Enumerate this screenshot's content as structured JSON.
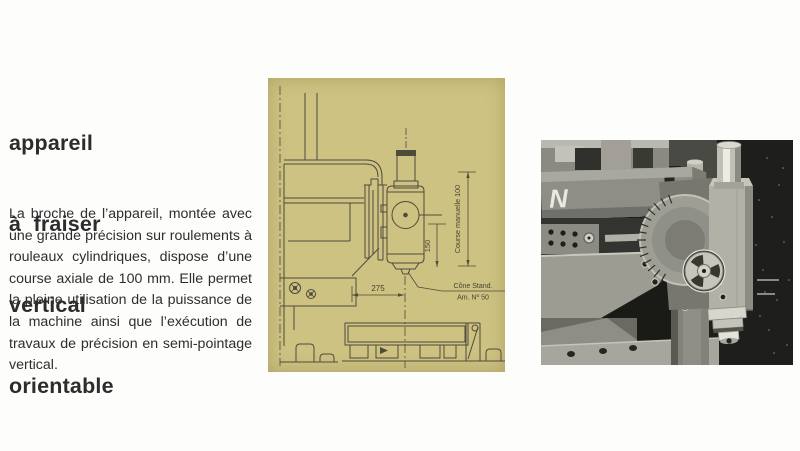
{
  "article": {
    "heading_lines": [
      "appareil",
      "à  fraiser",
      "vertical",
      "orientable"
    ],
    "body": "La broche de l’appareil, montée avec une grande précision sur roulements à rouleaux cylindriques, dispose d’une course axiale de 100 mm. Elle permet la pleine utilisation de la puissance de la machine ainsi que l’exécution de travaux de précision en semi-pointage vertical."
  },
  "diagram": {
    "labels": {
      "course": "Course manuelle 100",
      "dim_vertical": "150",
      "dim_horizontal": "275",
      "cone_line1": "Cône Stand.",
      "cone_line2": "Am. Nº 50"
    },
    "colors": {
      "background": "#cec282",
      "ink": "#4d4b3a"
    }
  },
  "photo": {
    "marking": "N",
    "colors": {
      "background": "#1e1e1c"
    }
  }
}
